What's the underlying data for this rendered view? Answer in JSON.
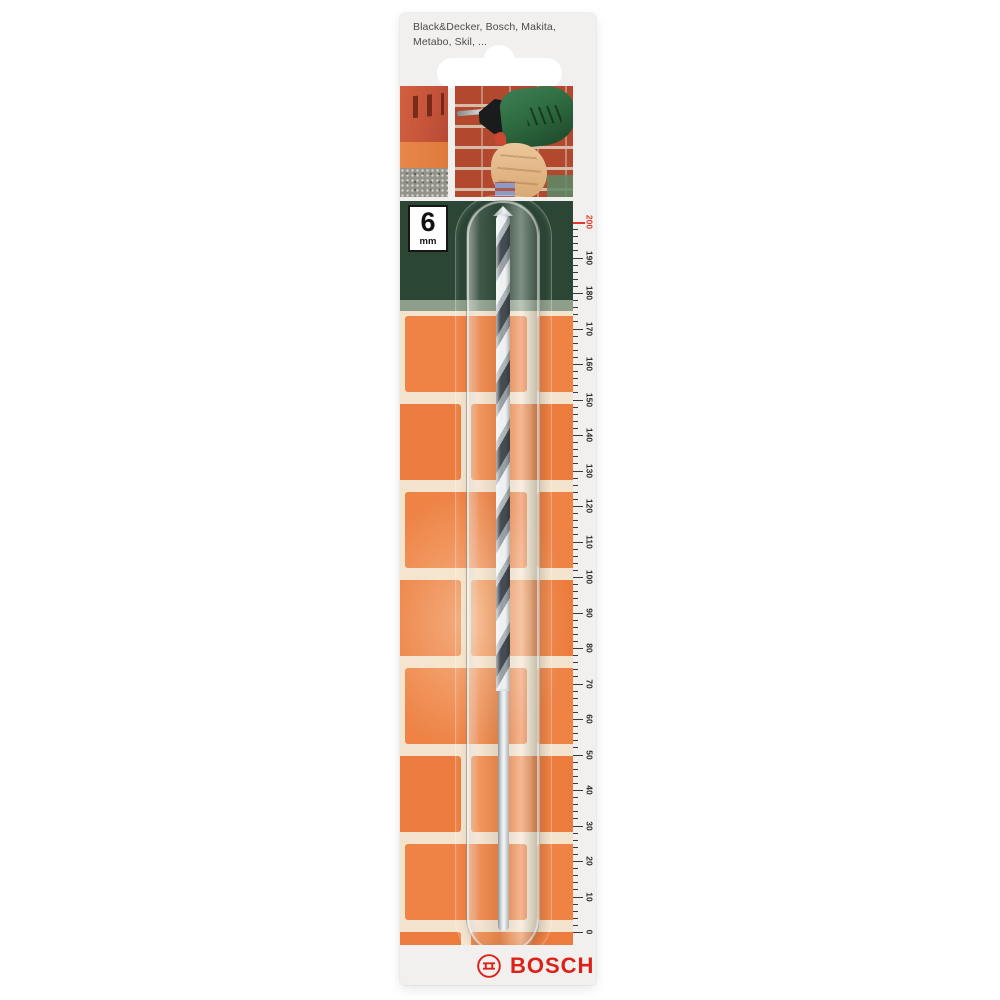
{
  "package": {
    "compatibility_note": "Black&Decker, Bosch, Makita, Metabo, Skil, ...",
    "size_badge": {
      "value": "6",
      "unit": "mm"
    },
    "brand": "BOSCH"
  },
  "ruler": {
    "min": 0,
    "max": 200,
    "minor_step": 2,
    "label_step": 10,
    "highlight_value": 200
  },
  "colors": {
    "card_bg": "#f1f0ee",
    "band_green": "#2b4634",
    "band_sage": "#8d9e8a",
    "brick_orange": "#ee8345",
    "brick_mortar": "#f4e3cd",
    "ruler_tick": "#3a3a3a",
    "ruler_highlight": "#e0392c",
    "bosch_red": "#dd2119",
    "badge_border": "#161616",
    "photo_wall_red": "#b2492f",
    "drill_green": "#2e6b40",
    "bit_silver": "#dfe4e6"
  }
}
